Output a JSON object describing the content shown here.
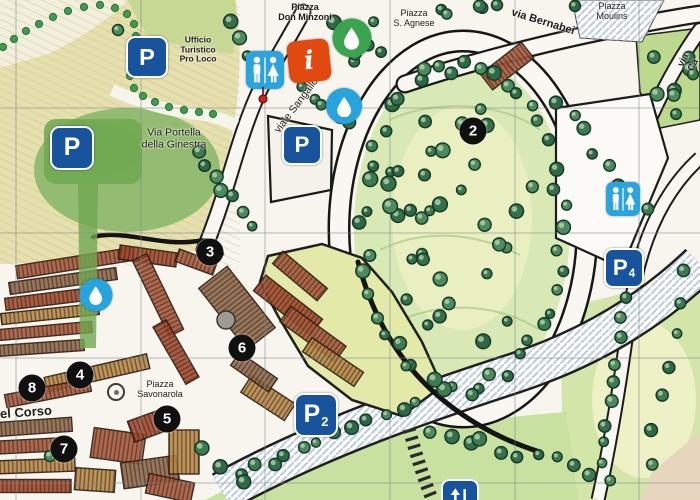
{
  "map": {
    "street_labels": [
      {
        "id": "piazza-don-minzoni",
        "text": "Piazza\nDon Minzoni",
        "x": 305,
        "y": 12,
        "rotate": 0,
        "size": 9,
        "weight": 700
      },
      {
        "id": "ufficio-turistico-pro-loco",
        "text": "Ufficio\nTuristico\nPro Loco",
        "x": 198,
        "y": 50,
        "rotate": 0,
        "size": 8.5,
        "weight": 700
      },
      {
        "id": "piazza-s-agnese",
        "text": "Piazza\nS. Agnese",
        "x": 414,
        "y": 18,
        "rotate": 0,
        "size": 9,
        "weight": 500
      },
      {
        "id": "via-bernabei",
        "text": "via Bernabei",
        "x": 543,
        "y": 22,
        "rotate": 17,
        "size": 11,
        "weight": 700
      },
      {
        "id": "piazza-moulins",
        "text": "Piazza\nMoulins",
        "x": 612,
        "y": 11,
        "rotate": 0,
        "size": 9,
        "weight": 500
      },
      {
        "id": "via-ca",
        "text": "via Ca",
        "x": 689,
        "y": 63,
        "rotate": -63,
        "size": 9.5,
        "weight": 700
      },
      {
        "id": "via-portella-della-ginestra",
        "text": "Via Portella\ndella Ginestra",
        "x": 174,
        "y": 139,
        "rotate": 0,
        "size": 10.5,
        "weight": 500
      },
      {
        "id": "viale-sangallo",
        "text": "viale Sangallo",
        "x": 297,
        "y": 106,
        "rotate": -53,
        "size": 10.5,
        "weight": 500
      },
      {
        "id": "piazza-savonarola",
        "text": "Piazza\nSavonarola",
        "x": 160,
        "y": 389,
        "rotate": 0,
        "size": 9,
        "weight": 500
      },
      {
        "id": "del-corso",
        "text": "del Corso",
        "x": 22,
        "y": 413,
        "rotate": -4,
        "size": 13,
        "weight": 700
      }
    ],
    "numbered_markers": [
      {
        "number": "2",
        "x": 473,
        "y": 131
      },
      {
        "number": "3",
        "x": 210,
        "y": 252
      },
      {
        "number": "4",
        "x": 80,
        "y": 375
      },
      {
        "number": "5",
        "x": 167,
        "y": 419
      },
      {
        "number": "6",
        "x": 242,
        "y": 348
      },
      {
        "number": "7",
        "x": 64,
        "y": 449
      },
      {
        "number": "8",
        "x": 32,
        "y": 388
      }
    ],
    "parking_signs": [
      {
        "id": "parking-pro-loco",
        "label": "P",
        "sub": "",
        "x": 147,
        "y": 57,
        "size": 38
      },
      {
        "id": "parking-ginestra",
        "label": "P",
        "sub": "",
        "x": 72,
        "y": 148,
        "size": 40
      },
      {
        "id": "parking-sangallo",
        "label": "P",
        "sub": "",
        "x": 302,
        "y": 145,
        "size": 36
      },
      {
        "id": "parking-2",
        "label": "P",
        "sub": "2",
        "x": 316,
        "y": 415,
        "size": 40
      },
      {
        "id": "parking-4",
        "label": "P",
        "sub": "4",
        "x": 624,
        "y": 268,
        "size": 36
      }
    ],
    "restroom_signs": [
      {
        "id": "restrooms-pro-loco",
        "x": 265,
        "y": 70,
        "size": 38,
        "pin": true
      },
      {
        "id": "restrooms-east",
        "x": 623,
        "y": 199,
        "size": 34,
        "pin": false
      }
    ],
    "water_fountains": [
      {
        "id": "fountain-don-minzoni",
        "color_key": "fountain_green",
        "x": 352,
        "y": 38,
        "d": 39
      },
      {
        "id": "fountain-sangallo",
        "color_key": "fountain_blue",
        "x": 344,
        "y": 106,
        "d": 36
      },
      {
        "id": "fountain-old-town",
        "color_key": "fountain_blue",
        "x": 96,
        "y": 295,
        "d": 33
      }
    ],
    "info_point": {
      "id": "tourist-info",
      "glyph": "i",
      "x": 309,
      "y": 61,
      "size": 42,
      "rotate": -6
    },
    "elevator": {
      "id": "elevator",
      "x": 460,
      "y": 498,
      "size": 34
    },
    "monument_dot": {
      "x": 116,
      "y": 392,
      "d": 14
    },
    "colors": {
      "parking_navy": "#17549d",
      "restroom_blue": "#29a4dd",
      "info_orange": "#e2490e",
      "fountain_green": "#3aa34d",
      "fountain_blue": "#27a3dd",
      "marker_black": "#101010",
      "pin_red": "#d41f1f"
    }
  }
}
